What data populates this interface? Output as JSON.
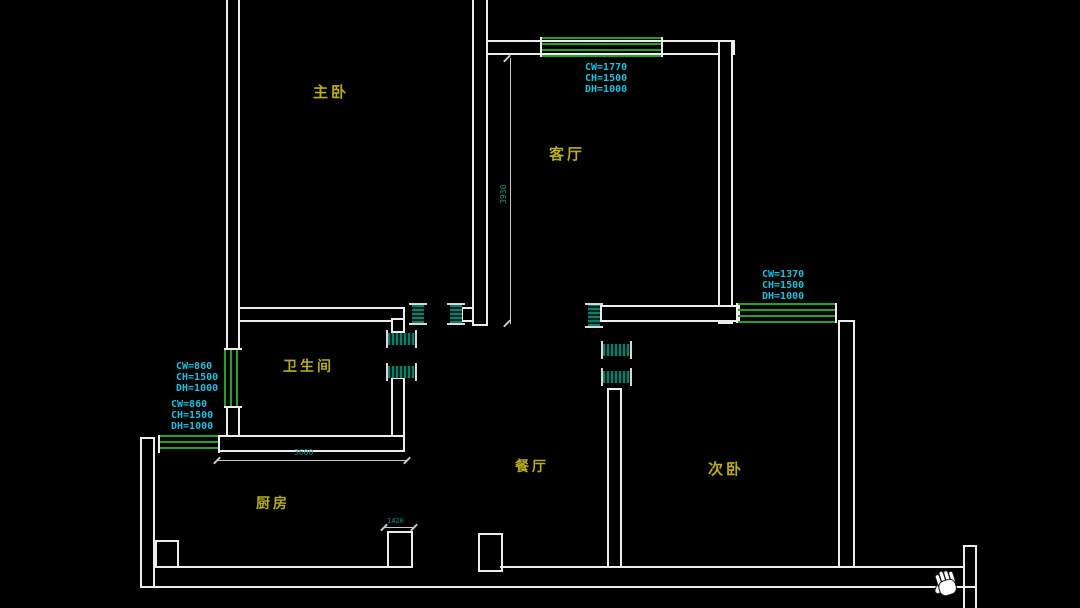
{
  "canvas": {
    "background": "#000000"
  },
  "rooms": [
    {
      "name": "master-bedroom",
      "label": "主卧"
    },
    {
      "name": "living-room",
      "label": "客厅"
    },
    {
      "name": "bathroom",
      "label": "卫生间"
    },
    {
      "name": "kitchen",
      "label": "厨房"
    },
    {
      "name": "dining-room",
      "label": "餐厅"
    },
    {
      "name": "second-bedroom",
      "label": "次卧"
    }
  ],
  "window_annotations": {
    "living_room": [
      "CW=1770",
      "CH=1500",
      "DH=1000"
    ],
    "second_bedroom": [
      "CW=1370",
      "CH=1500",
      "DH=1000"
    ],
    "bathroom": [
      "CW=860",
      "CH=1500",
      "DH=1000"
    ],
    "kitchen": [
      "CW=860",
      "CH=1500",
      "DH=1000"
    ]
  },
  "dimensions": {
    "kitchen_width": "3600",
    "living_room_depth": "3930",
    "kitchen_door": "1420"
  },
  "cursor": {
    "type": "pan-hand"
  },
  "colors": {
    "wall": "#ececec",
    "window_green": "#22a028",
    "room_label_yellow": "#b8ac1a",
    "annotation_cyan": "#1ac0dd",
    "dimension_teal": "#12907e"
  }
}
